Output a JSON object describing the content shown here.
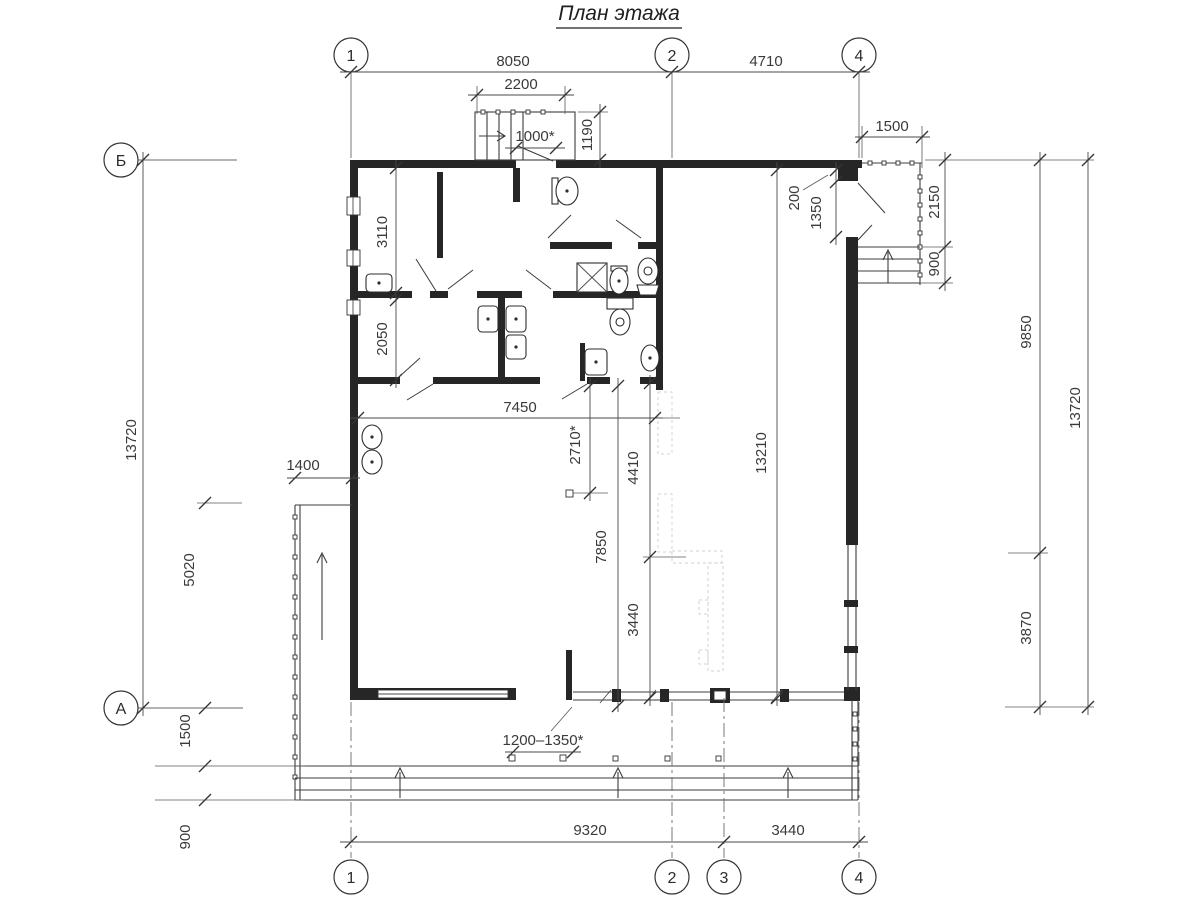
{
  "title": "План этажа",
  "grid": {
    "top": [
      "1",
      "2",
      "4"
    ],
    "bottom": [
      "1",
      "2",
      "3",
      "4"
    ],
    "left": [
      "Б",
      "А"
    ]
  },
  "dimensions": {
    "d8050": "8050",
    "d4710": "4710",
    "d2200": "2200",
    "d1000": "1000*",
    "d1190": "1190",
    "d1500_top": "1500",
    "d200": "200",
    "d1350": "1350",
    "d2150": "2150",
    "d900_porch": "900",
    "d9850": "9850",
    "d3870": "3870",
    "d13720_right": "13720",
    "d13720_left": "13720",
    "d3110": "3110",
    "d2050": "2050",
    "d1400": "1400",
    "d5020": "5020",
    "d1500_left": "1500",
    "d900_left": "900",
    "d7450": "7450",
    "d2710": "2710*",
    "d7850": "7850",
    "d4410": "4410",
    "d3440_mid": "3440",
    "d13210": "13210",
    "d1200_1350": "1200–1350*",
    "d9320": "9320",
    "d3440_bottom": "3440"
  }
}
